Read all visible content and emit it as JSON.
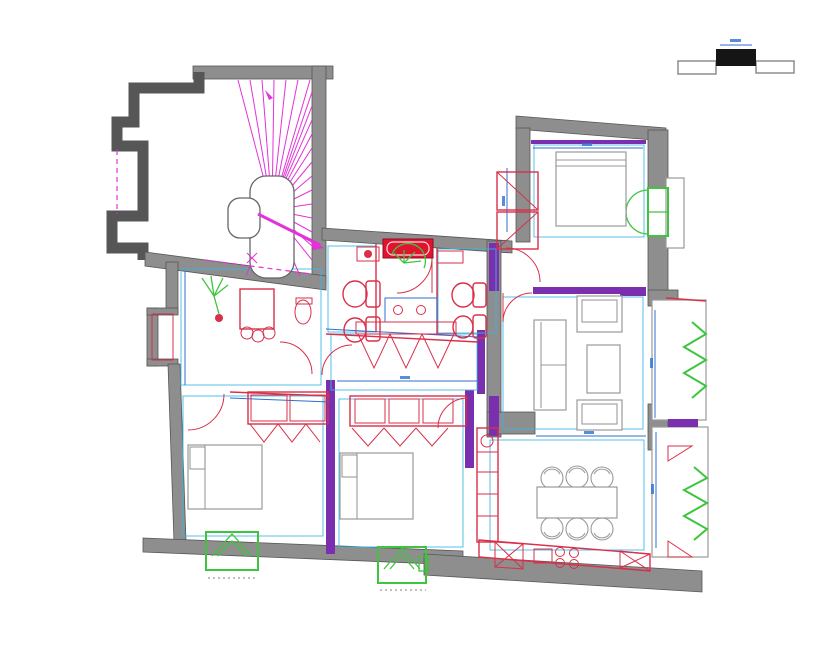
{
  "palette": {
    "background": "#ffffff",
    "wall_fill": "#8e8e8e",
    "wall_stroke": "#565656",
    "partition_purple": "#7a2fae",
    "cad_blue": "#2f6fd0",
    "cad_cyan": "#3ab4e4",
    "fixture_red": "#d92f49",
    "fixture_red_dark": "#e0142f",
    "stair_magenta": "#e432d8",
    "window_green": "#3ec43e",
    "furniture_gray": "#9a9a9a",
    "section_black": "#151515"
  },
  "drawing": {
    "kind": "architectural-floor-plan",
    "rooms": [
      "stairwell",
      "entry-hall",
      "corridor",
      "wc",
      "bathroom",
      "bedroom-1",
      "bedroom-2",
      "master-bedroom",
      "living-room",
      "dining-room",
      "kitchen",
      "balcony"
    ],
    "symbols": [
      "wall-section-marker",
      "stair-treads",
      "stair-direction-arrow",
      "door-swing-arc",
      "window-with-shutters",
      "radiator-hatch",
      "wardrobe-hatch",
      "toilet",
      "bidet",
      "bathtub",
      "washbasin",
      "cooktop-burners",
      "kitchen-counter",
      "dining-table-with-chairs",
      "sofa",
      "armchair",
      "coffee-table",
      "bed",
      "plant"
    ]
  }
}
